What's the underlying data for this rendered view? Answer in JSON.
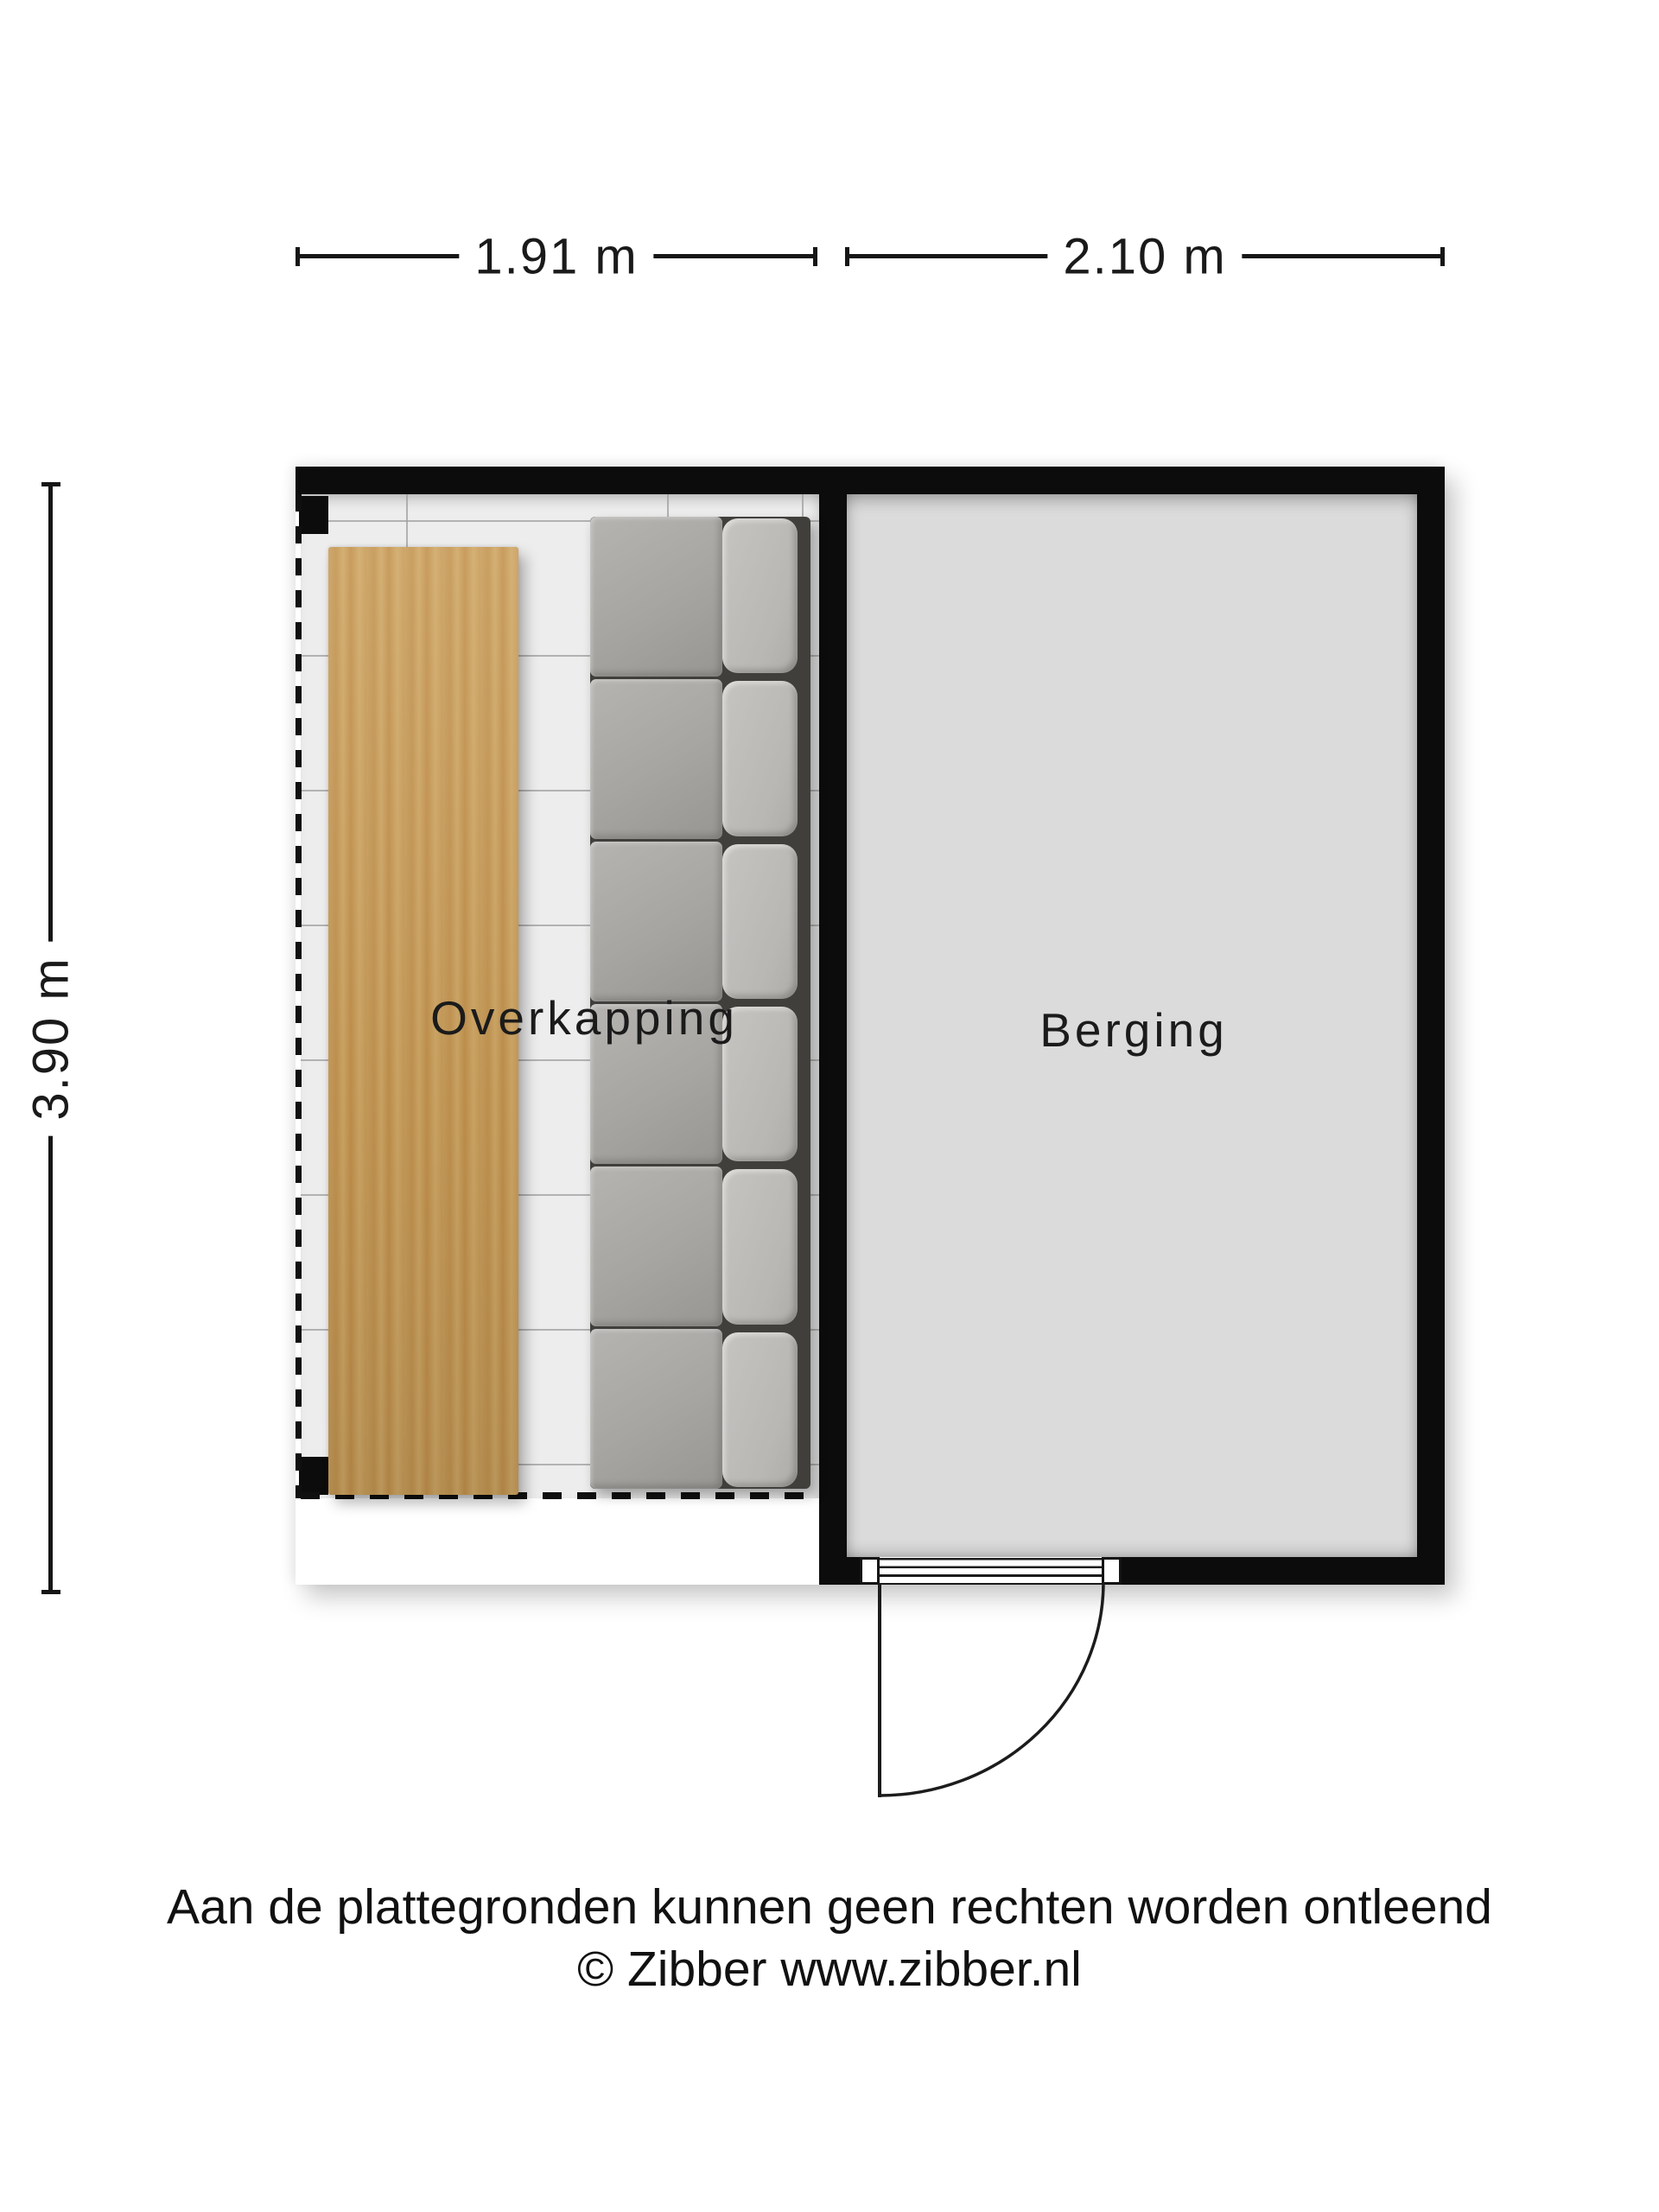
{
  "floorplan": {
    "dimensions": {
      "top_left": "1.91 m",
      "top_right": "2.10 m",
      "left": "3.90 m"
    },
    "rooms": [
      {
        "name": "overkapping",
        "label": "Overkapping"
      },
      {
        "name": "berging",
        "label": "Berging"
      }
    ],
    "furniture": [
      {
        "name": "wooden-table"
      },
      {
        "name": "sofa"
      }
    ],
    "footer": {
      "line1": "Aan de plattegronden kunnen geen rechten worden ontleend",
      "line2": "© Zibber www.zibber.nl"
    },
    "colors": {
      "wall": "#0c0c0c",
      "berging_floor": "#dbdbdb",
      "overkapping_floor": "#ededed",
      "wood": "#c79b58",
      "sofa_seat": "#a7a5a1",
      "sofa_back": "#bcbab6",
      "text": "#1a1a1a"
    }
  }
}
